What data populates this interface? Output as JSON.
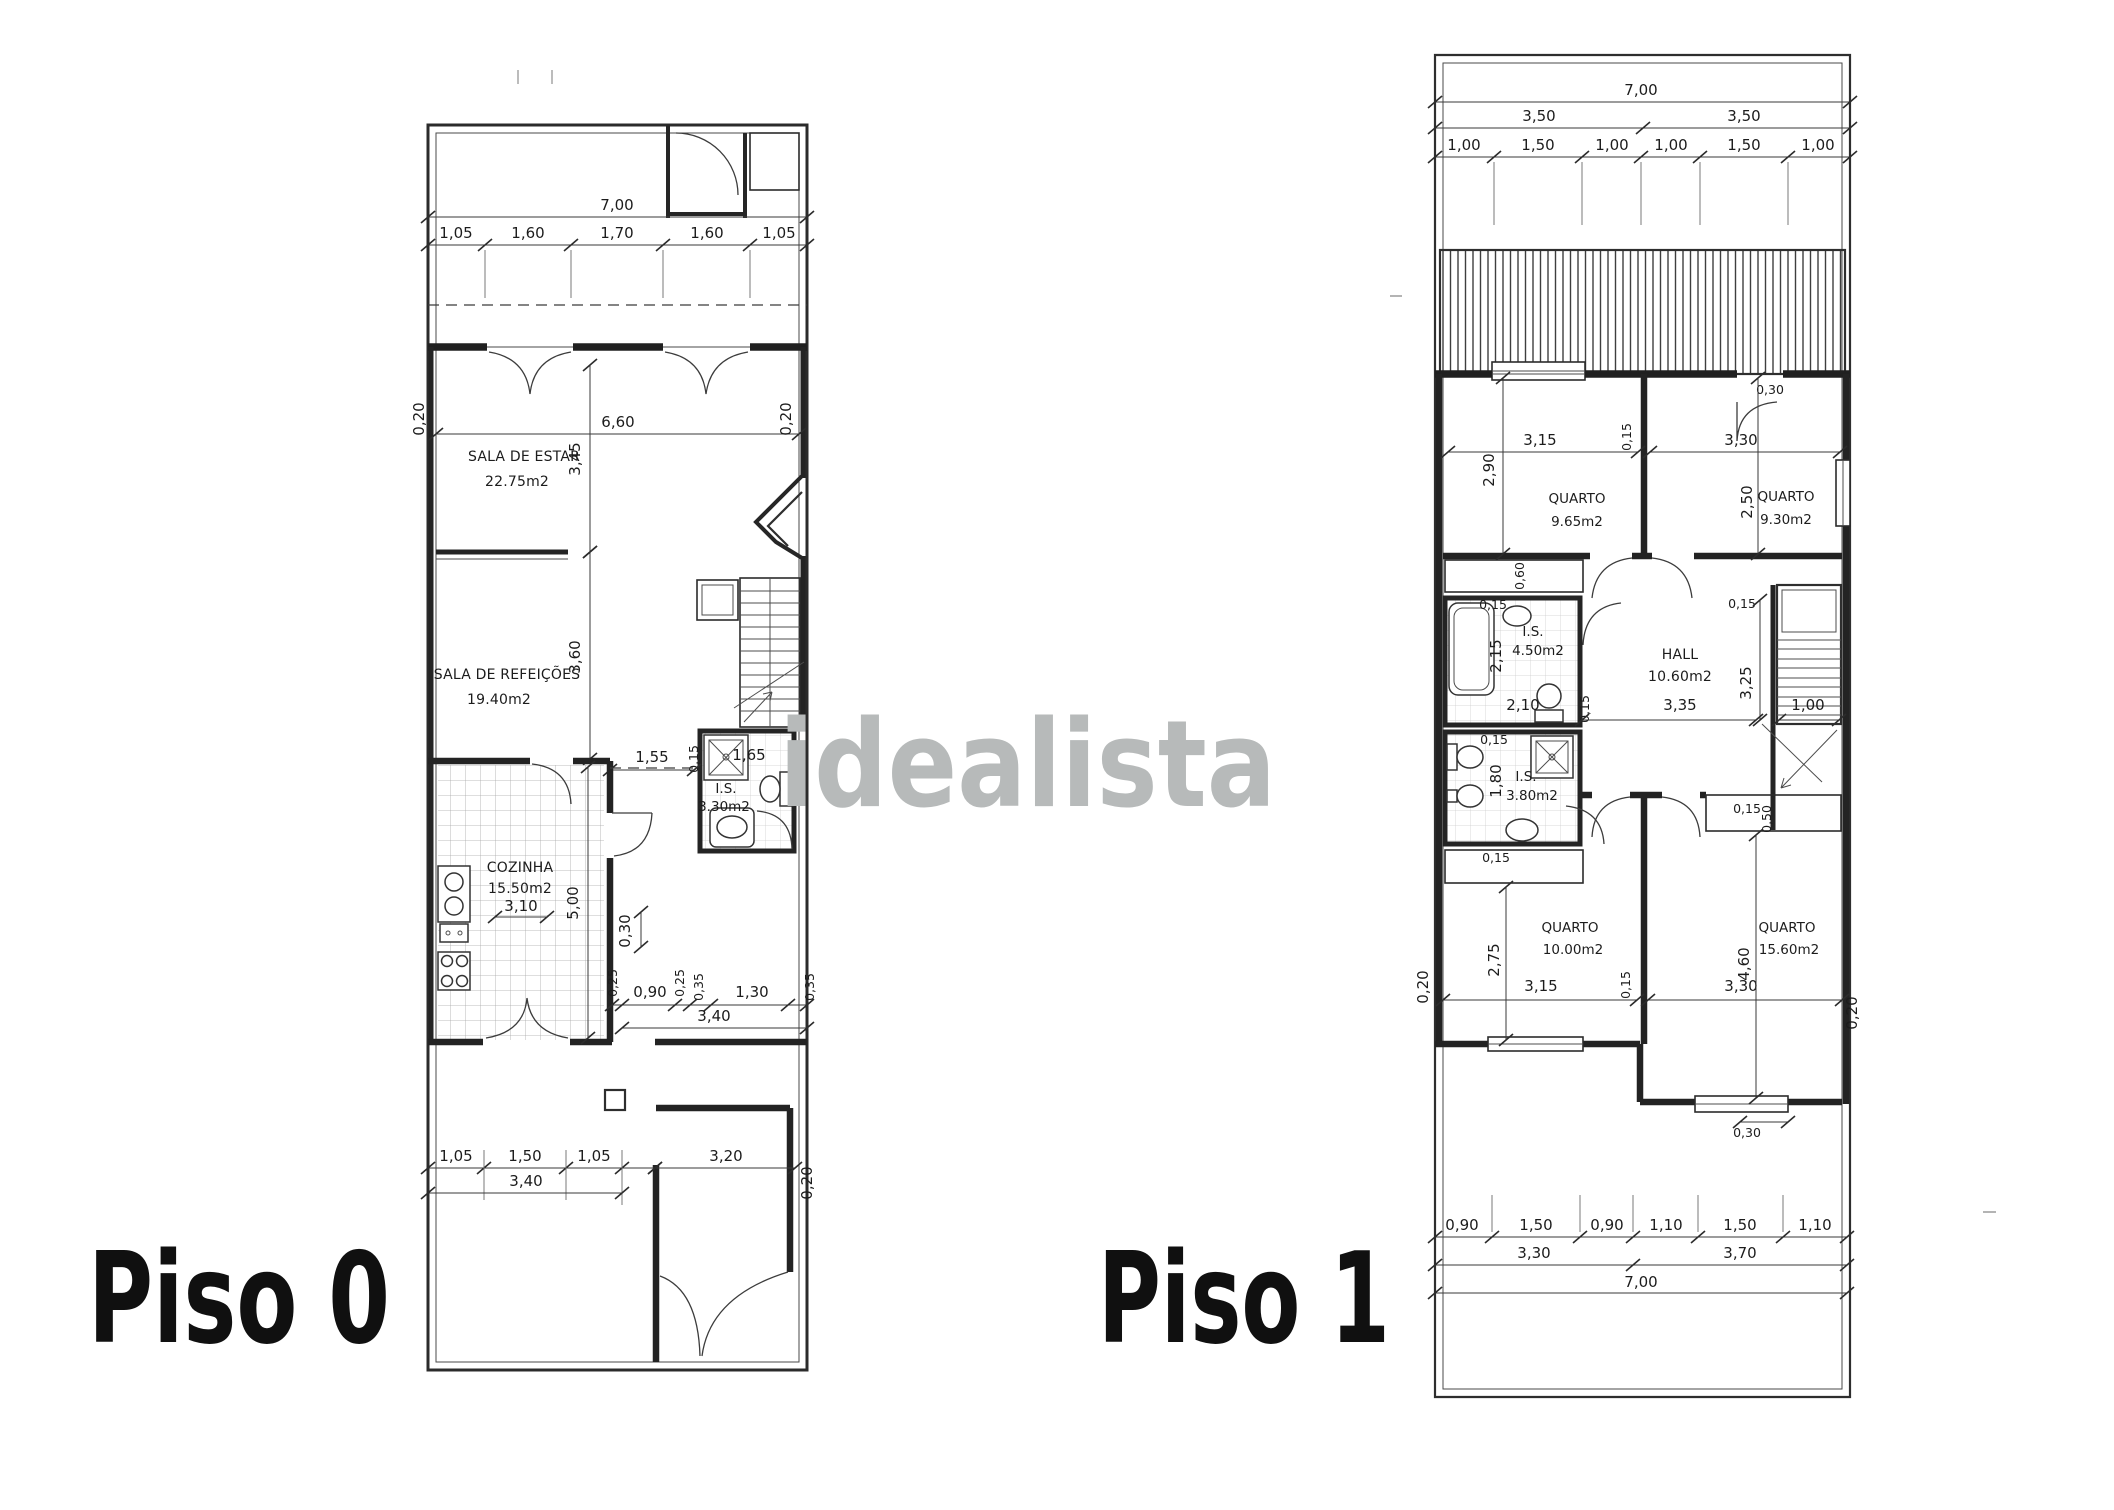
{
  "watermark": {
    "text": "idealista"
  },
  "floors": {
    "piso0": {
      "label": "Piso 0",
      "rooms": {
        "sala_estar": {
          "name": "SALA DE ESTAR",
          "area": "22.75m2"
        },
        "sala_refeicoes": {
          "name": "SALA DE REFEIÇÕES",
          "area": "19.40m2"
        },
        "cozinha": {
          "name": "COZINHA",
          "area": "15.50m2"
        },
        "is": {
          "name": "I.S.",
          "area": "3.30m2"
        }
      },
      "dims": {
        "top_total": "7,00",
        "top_segs": [
          "1,05",
          "1,60",
          "1,70",
          "1,60",
          "1,05"
        ],
        "estar_width": "6,60",
        "estar_depth": "3,45",
        "wall_left": "0,20",
        "wall_right": "0,20",
        "refeicoes_depth": "3,60",
        "is_left": "1,55",
        "is_wall": "0,15",
        "is_width": "1,65",
        "cozinha_width": "3,10",
        "cozinha_depth": "5,00",
        "hall_step": "0,30",
        "hall_segs": [
          "0,25",
          "0,90",
          "0,25",
          "0,35",
          "1,30",
          "0,35"
        ],
        "hall_total": "3,40",
        "bottom_segs": [
          "1,05",
          "1,50",
          "1,05"
        ],
        "bottom_sub": "3,40",
        "bottom_right": "3,20",
        "bottom_wall": "0,20"
      }
    },
    "piso1": {
      "label": "Piso 1",
      "rooms": {
        "quarto1": {
          "name": "QUARTO",
          "area": "9.65m2"
        },
        "quarto2": {
          "name": "QUARTO",
          "area": "9.30m2"
        },
        "is1": {
          "name": "I.S.",
          "area": "4.50m2"
        },
        "hall": {
          "name": "HALL",
          "area": "10.60m2"
        },
        "is2": {
          "name": "I.S.",
          "area": "3.80m2"
        },
        "quarto3": {
          "name": "QUARTO",
          "area": "10.00m2"
        },
        "quarto4": {
          "name": "QUARTO",
          "area": "15.60m2"
        }
      },
      "dims": {
        "top_total": "7,00",
        "top_halves": [
          "3,50",
          "3,50"
        ],
        "top_segs": [
          "1,00",
          "1,50",
          "1,00",
          "1,00",
          "1,50",
          "1,00"
        ],
        "terrace_door": "0,30",
        "q1_width": "3,15",
        "q1_depth": "2,90",
        "q1_wall": "0,15",
        "q2_width": "3,30",
        "q2_depth": "2,50",
        "wardrobe1": "0,60",
        "is1_wall_top": "0,15",
        "is1_depth": "2,15",
        "is1_width": "2,10",
        "is1_wall_right": "0,15",
        "hall_width": "3,35",
        "hall_depth": "3,25",
        "hall_wall": "0,15",
        "stairs_width": "1,00",
        "closet_wall": "0,15",
        "closet_depth": "0,50",
        "is2_wall": "0,15",
        "is2_depth": "1,80",
        "wardrobe2": "0,15",
        "q3_width": "3,15",
        "q3_depth": "2,75",
        "q3_wall": "0,15",
        "q4_width": "3,30",
        "q4_depth": "4,60",
        "wall_left": "0,20",
        "wall_right": "0,20",
        "bottom_door": "0,30",
        "bottom_segs": [
          "0,90",
          "1,50",
          "0,90",
          "1,10",
          "1,50",
          "1,10"
        ],
        "bottom_subs": [
          "3,30",
          "3,70"
        ],
        "bottom_total": "7,00"
      }
    }
  }
}
